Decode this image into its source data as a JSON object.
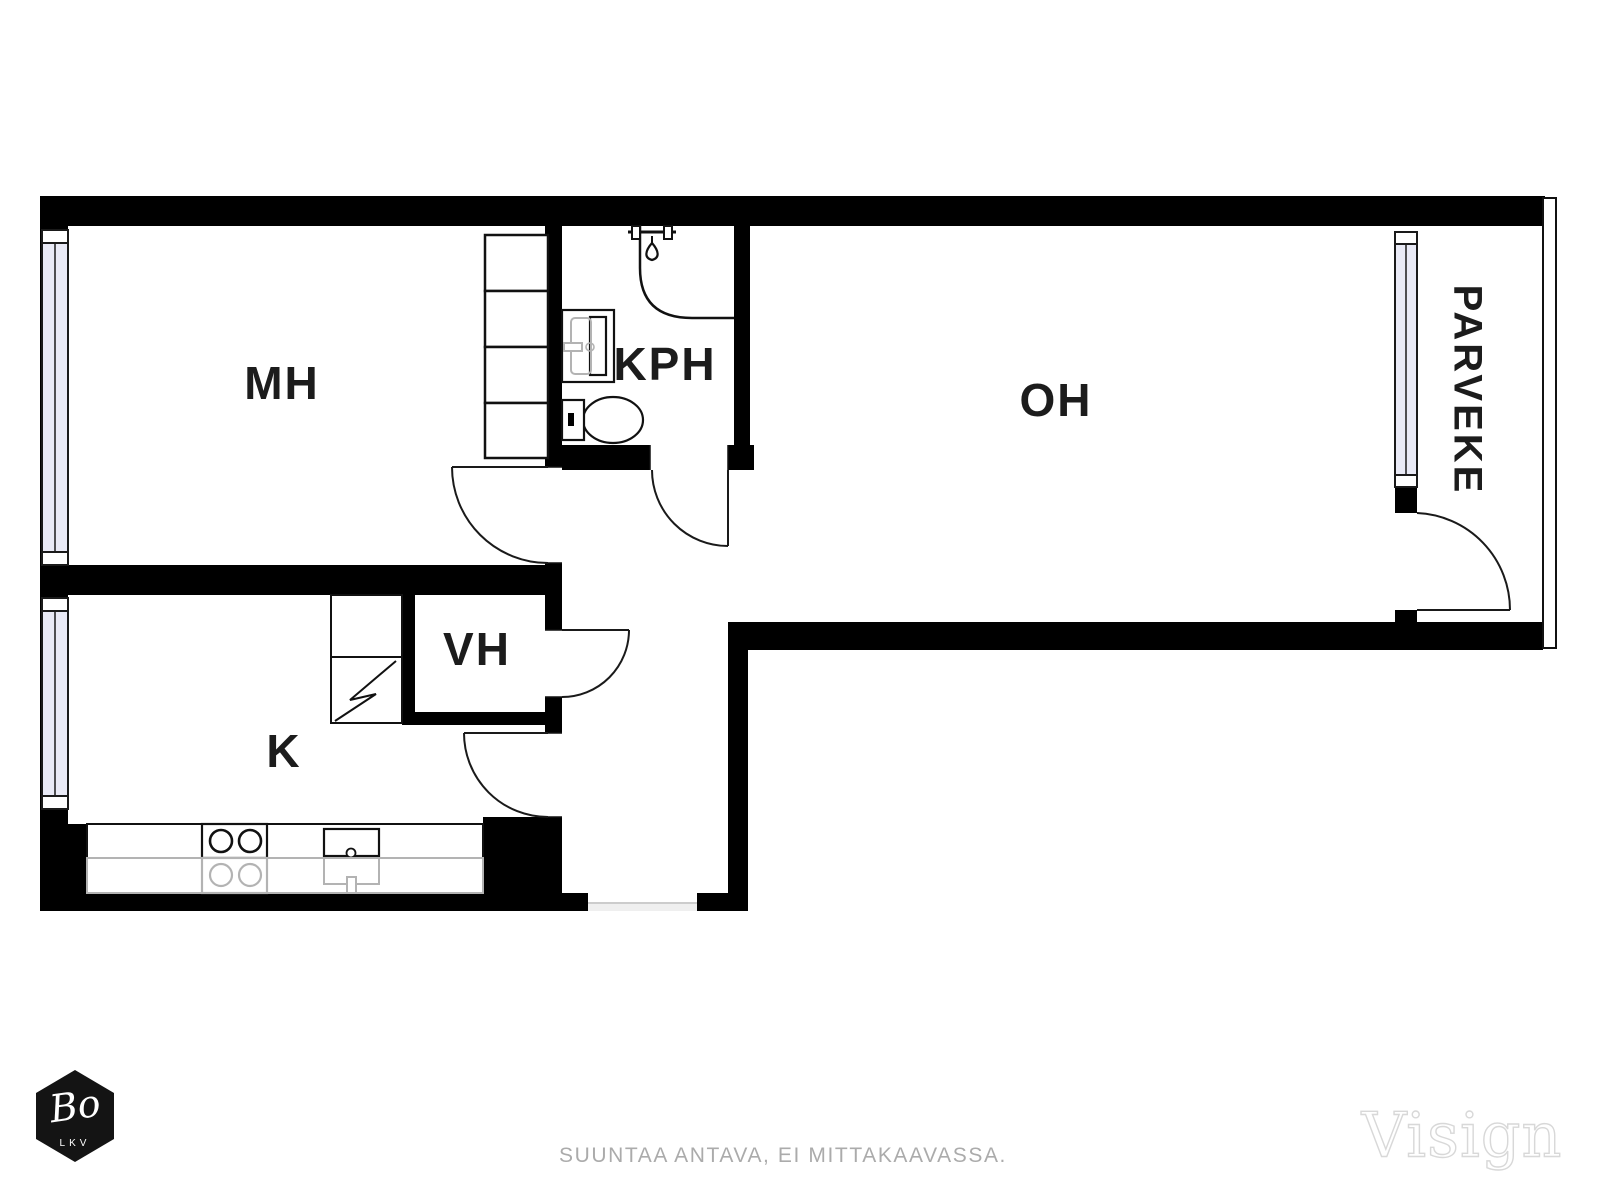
{
  "floorplan": {
    "rooms": [
      {
        "id": "mh",
        "label": "MH"
      },
      {
        "id": "k",
        "label": "K"
      },
      {
        "id": "vh",
        "label": "VH"
      },
      {
        "id": "kph",
        "label": "KPH"
      },
      {
        "id": "oh",
        "label": "OH"
      },
      {
        "id": "parveke",
        "label": "PARVEKE"
      }
    ],
    "fixtures": [
      "wardrobe",
      "fridge",
      "stove",
      "kitchen-sink",
      "shower",
      "washbasin",
      "toilet"
    ]
  },
  "footer": {
    "disclaimer": "SUUNTAA ANTAVA, EI MITTAKAAVASSA."
  },
  "branding": {
    "logo_script": "Bo",
    "logo_sub": "LKV",
    "watermark": "Visign"
  },
  "colors": {
    "wall": "#000000",
    "line": "#111111",
    "window_fill": "#e9eaf6",
    "fixture_gray": "#b3b3b3",
    "label_text": "#1c1c1c",
    "footer_text": "#ababab",
    "watermark_outline": "#d8d8d8",
    "logo_bg": "#141414"
  }
}
